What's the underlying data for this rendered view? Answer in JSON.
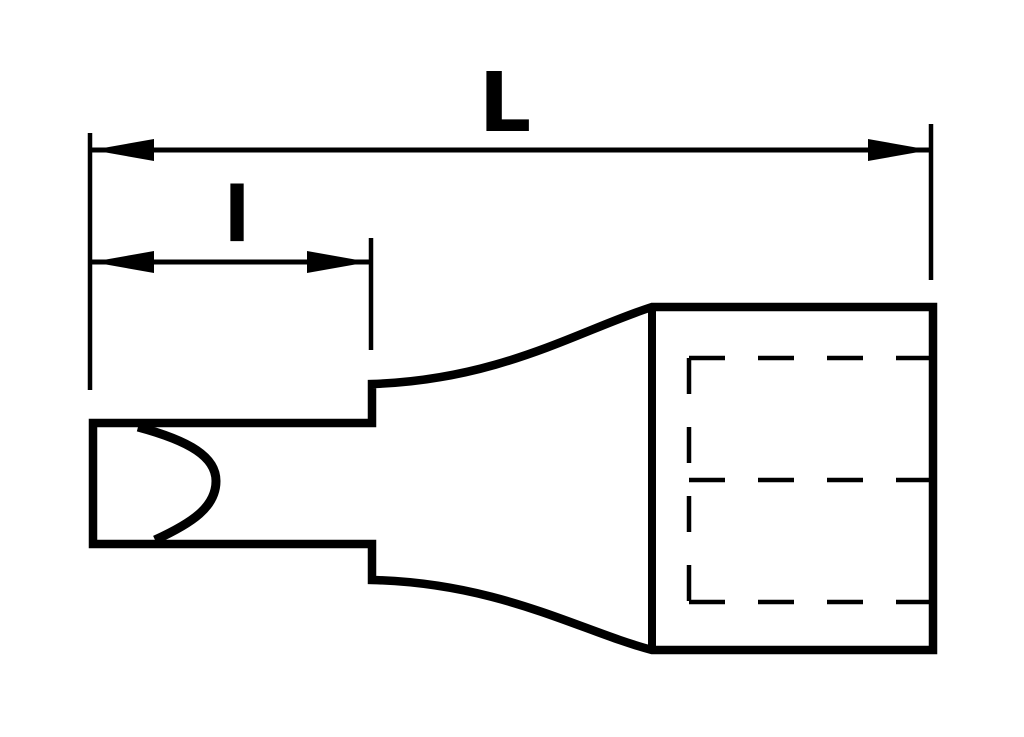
{
  "page": {
    "background_color": "#ffffff",
    "ink_color": "#000000"
  },
  "drawing": {
    "kind": "technical-line-drawing",
    "labels": {
      "overall_length": "L",
      "tip_length": "l"
    }
  }
}
